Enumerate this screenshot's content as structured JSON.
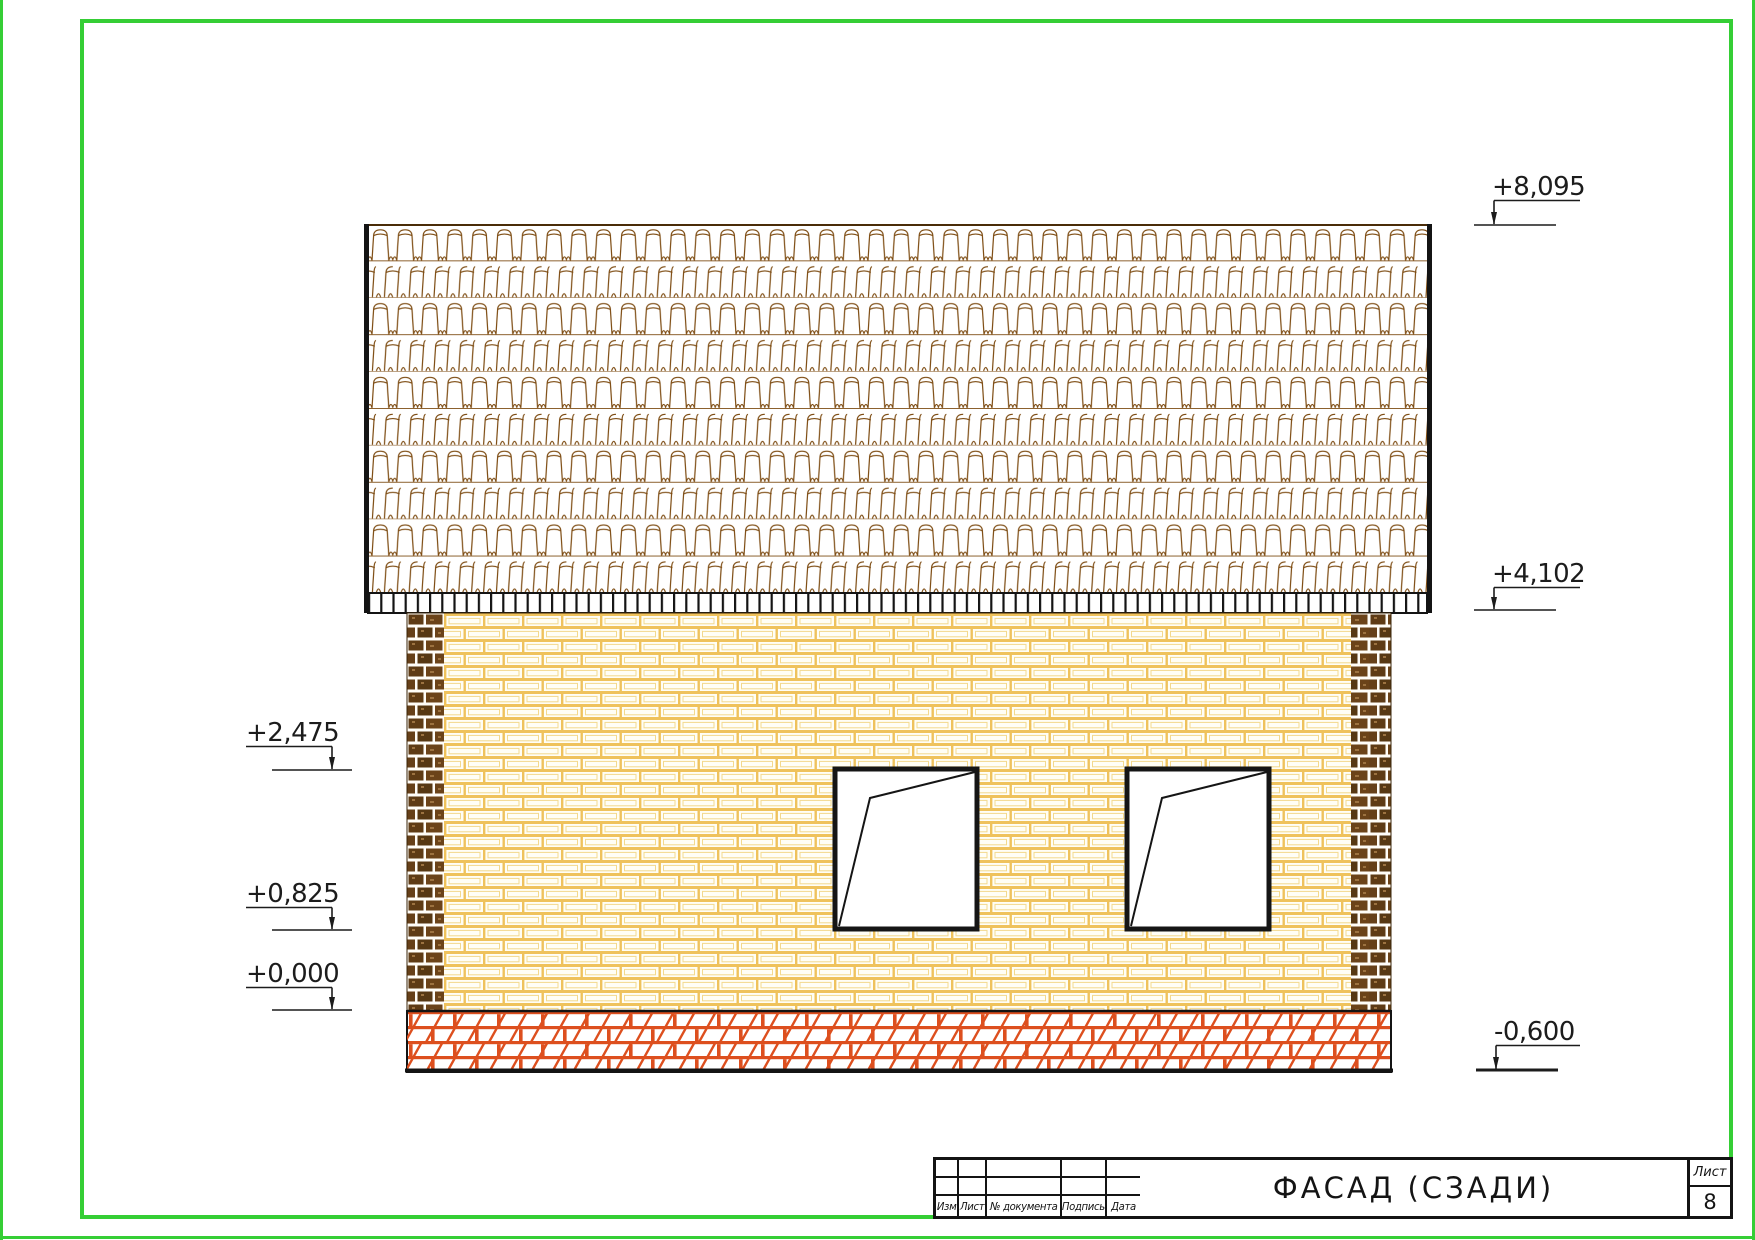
{
  "elevation_marks": {
    "roof_top": "+8,095",
    "eaves": "+4,102",
    "window_head": "+2,475",
    "window_sill": "+0,825",
    "ground": "+0,000",
    "foundation_bottom": "-0,600"
  },
  "title_block": {
    "title": "ФАСАД (СЗАДИ)",
    "sheet_label": "Лист",
    "sheet_number": "8",
    "columns": [
      "Изм",
      "Лист",
      "№ документа",
      "Подпись",
      "Дата"
    ]
  },
  "colors": {
    "frame_green": "#35ce35",
    "roof_tile_brown": "#7c4a10",
    "brick_mortar_yellow": "#efc25c",
    "pilaster_brown": "#5e3b15",
    "foundation_orange": "#dd4f1e",
    "line_black": "#141414"
  }
}
